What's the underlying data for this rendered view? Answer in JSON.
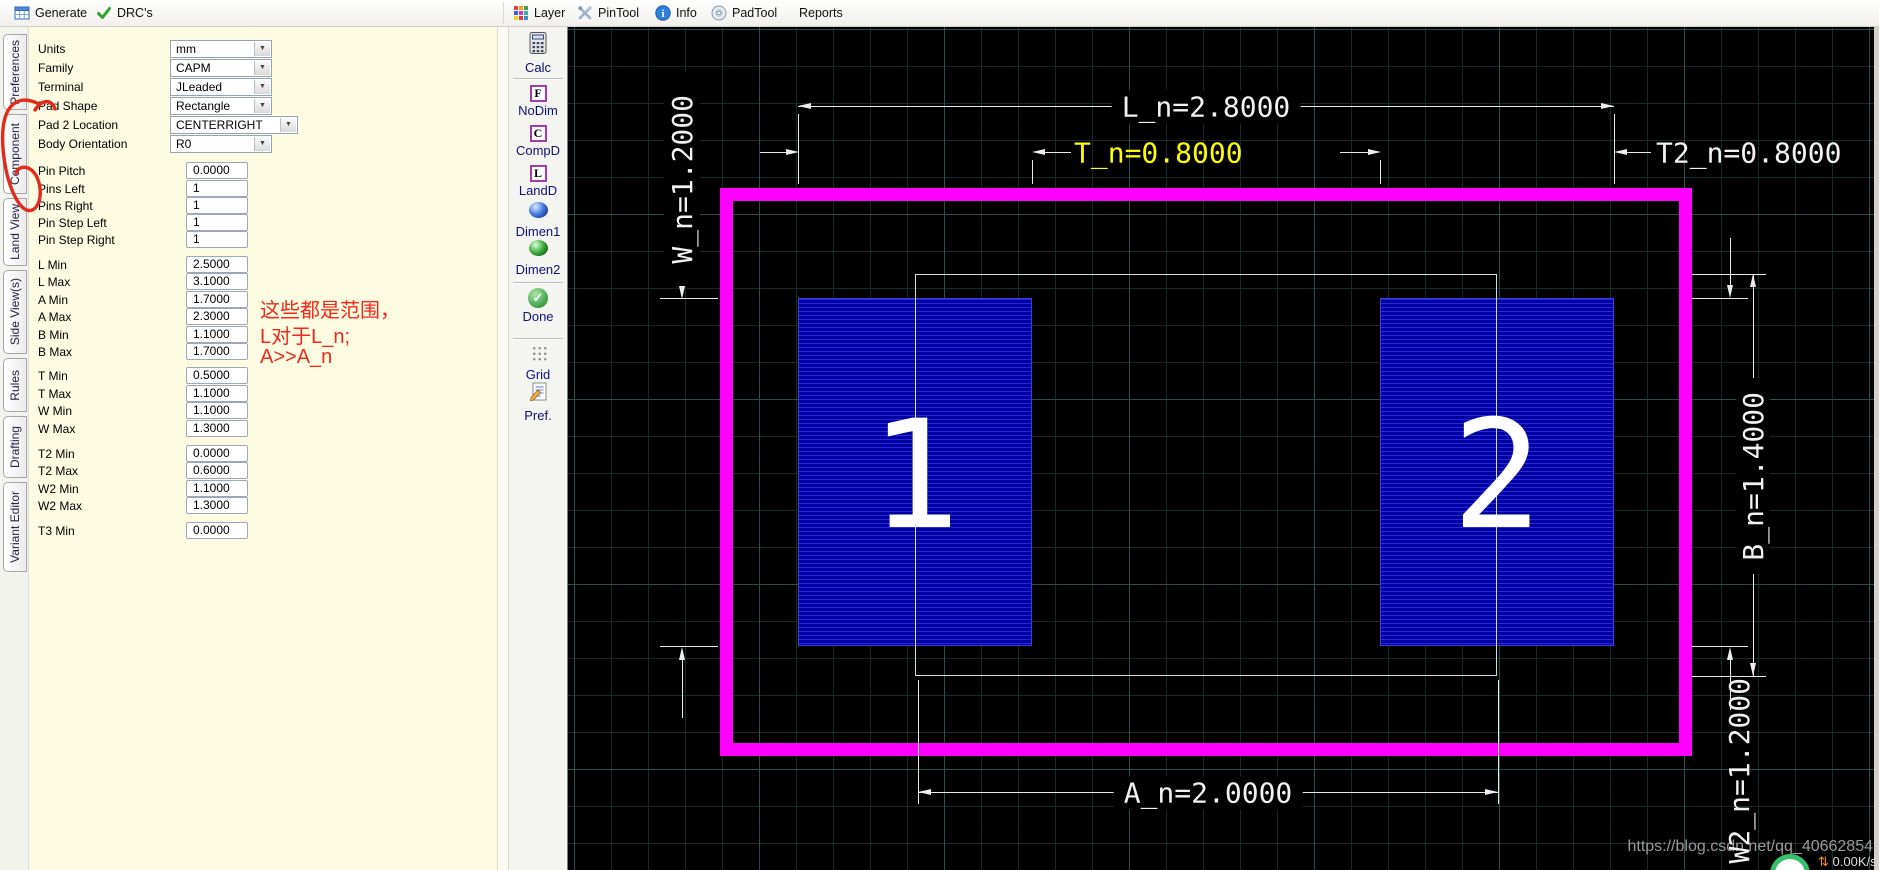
{
  "toolbar": {
    "generate": "Generate",
    "drcs": "DRC's",
    "right": [
      "Layer",
      "PinTool",
      "Info",
      "PadTool",
      "Reports"
    ]
  },
  "tabs": [
    "Preferences",
    "Component",
    "Land View",
    "Side View(s)",
    "Rules",
    "Drafting",
    "Variant Editor"
  ],
  "form": {
    "rows": [
      {
        "label": "Units",
        "value": "mm"
      },
      {
        "label": "Family",
        "value": "CAPM"
      },
      {
        "label": "Terminal",
        "value": "JLeaded"
      },
      {
        "label": "Pad Shape",
        "value": "Rectangle"
      },
      {
        "label": "Pad 2 Location",
        "value": "CENTERRIGHT"
      },
      {
        "label": "Body Orientation",
        "value": "R0"
      },
      {
        "label": "Pin Pitch",
        "value": "0.0000"
      },
      {
        "label": "Pins Left",
        "value": "1"
      },
      {
        "label": "Pins Right",
        "value": "1"
      },
      {
        "label": "Pin Step Left",
        "value": "1"
      },
      {
        "label": "Pin Step Right",
        "value": "1"
      },
      {
        "label": "L Min",
        "value": "2.5000"
      },
      {
        "label": "L Max",
        "value": "3.1000"
      },
      {
        "label": "A Min",
        "value": "1.7000"
      },
      {
        "label": "A Max",
        "value": "2.3000"
      },
      {
        "label": "B Min",
        "value": "1.1000"
      },
      {
        "label": "B Max",
        "value": "1.7000"
      },
      {
        "label": "T Min",
        "value": "0.5000"
      },
      {
        "label": "T Max",
        "value": "1.1000"
      },
      {
        "label": "W Min",
        "value": "1.1000"
      },
      {
        "label": "W Max",
        "value": "1.3000"
      },
      {
        "label": "T2 Min",
        "value": "0.0000"
      },
      {
        "label": "T2 Max",
        "value": "0.6000"
      },
      {
        "label": "W2 Min",
        "value": "1.1000"
      },
      {
        "label": "W2 Max",
        "value": "1.3000"
      },
      {
        "label": "T3 Min",
        "value": "0.0000"
      }
    ]
  },
  "note": {
    "l1": "这些都是范围，",
    "l2": "L对于L_n;",
    "l3": "A>>A_n",
    "color": "#f42718"
  },
  "iconbar": [
    {
      "label": "Calc",
      "icon": "calculator-icon"
    },
    {
      "label": "NoDim",
      "icon": "letter-f-icon"
    },
    {
      "label": "CompD",
      "icon": "letter-c-icon"
    },
    {
      "label": "LandD",
      "icon": "letter-l-icon"
    },
    {
      "label": "Dimen1",
      "icon": "blue-sphere-icon"
    },
    {
      "label": "Dimen2",
      "icon": "green-sphere-icon"
    },
    {
      "label": "Done",
      "icon": "green-check-icon"
    },
    {
      "label": "Grid",
      "icon": "dot-grid-icon"
    },
    {
      "label": "Pref.",
      "icon": "doc-pencil-icon"
    }
  ],
  "canvas": {
    "pad1": "1",
    "pad2": "2",
    "dim_L": "L_n=2.8000",
    "dim_T": "T_n=0.8000",
    "dim_T2": "T2_n=0.8000",
    "dim_W": "W_n=1.2000",
    "dim_B": "B_n=1.4000",
    "dim_A": "A_n=2.0000",
    "dim_W2": "W2_n=1.2000",
    "colors": {
      "outline": "#ff00ff",
      "pad": "#0202a0",
      "dim": "#f2f2f2",
      "dim_highlight": "#ffff00"
    }
  },
  "watermark": "https://blog.csdn.net/qq_40662854",
  "net_speed": "0.00K/s"
}
